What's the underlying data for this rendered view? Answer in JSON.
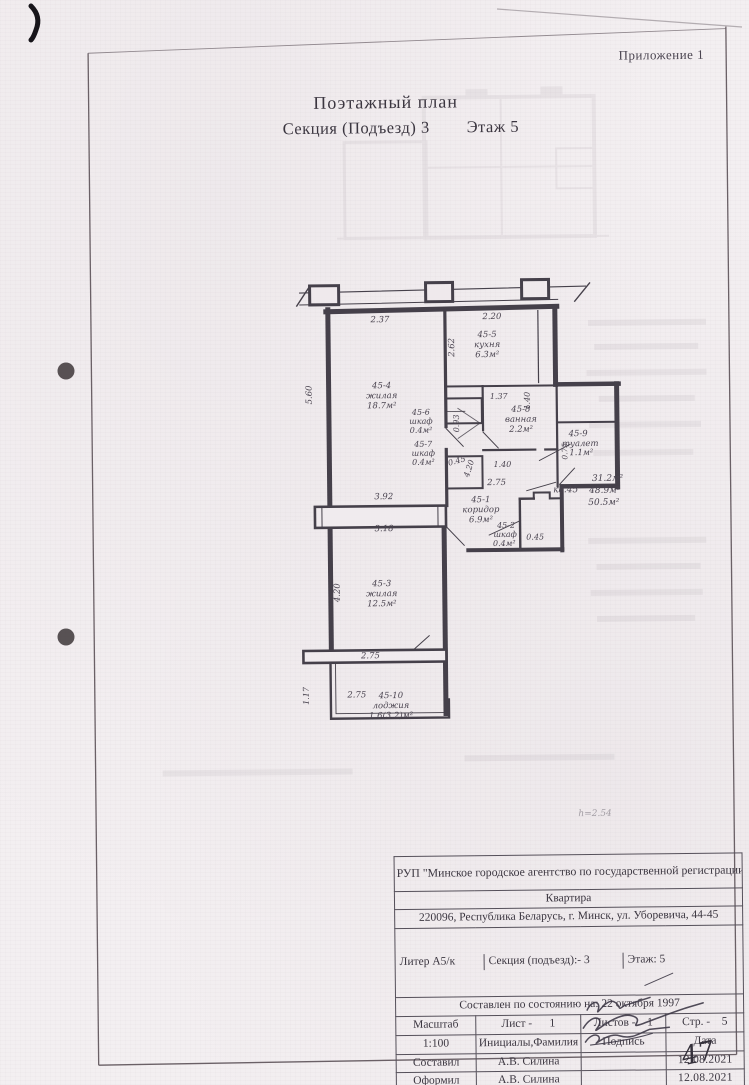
{
  "page": {
    "annex_label": "Приложение 1",
    "title_line1": "Поэтажный план",
    "title_line2": "Секция (Подъезд) 3        Этаж 5",
    "page_number_handwritten": "47"
  },
  "plan": {
    "apartment_ref": "кв.45",
    "areas_summary": [
      "31.2м²",
      "48.9м²",
      "50.5м²"
    ],
    "height_note": "h=2.54",
    "rooms": [
      {
        "number": "45-1",
        "name": "коридор",
        "area": "6.9м²"
      },
      {
        "number": "45-2",
        "name": "шкаф",
        "area": "0.4м²"
      },
      {
        "number": "45-3",
        "name": "жилая",
        "area": "12.5м²"
      },
      {
        "number": "45-4",
        "name": "жилая",
        "area": "18.7м²"
      },
      {
        "number": "45-5",
        "name": "кухня",
        "area": "6.3м²"
      },
      {
        "number": "45-6",
        "name": "шкаф",
        "area": "0.4м²"
      },
      {
        "number": "45-7",
        "name": "шкаф",
        "area": "0.4м²"
      },
      {
        "number": "45-8",
        "name": "ванная",
        "area": "2.2м²"
      },
      {
        "number": "45-9",
        "name": "туалет",
        "area": "1.1м²"
      },
      {
        "number": "45-10",
        "name": "лоджия",
        "area": "1.6(3.2)м²"
      }
    ],
    "dimensions": [
      "2.37",
      "2.20",
      "2.62",
      "5.60",
      "0.93",
      "1.37",
      "1.40",
      "0.75",
      "1.40",
      "0.45",
      "4.20",
      "2.75",
      "3.92",
      "3.18",
      "0.45",
      "4.20",
      "2.75",
      "2.75",
      "1.17"
    ],
    "labels": [
      {
        "t": "2.37",
        "x": 382,
        "y": 322,
        "r": 0,
        "s": 8.5
      },
      {
        "t": "2.20",
        "x": 494,
        "y": 320,
        "r": 0,
        "s": 8.5
      },
      {
        "t": "2.62",
        "x": 456,
        "y": 348,
        "r": -90,
        "s": 8.5
      },
      {
        "t": "5.60",
        "x": 313,
        "y": 394,
        "r": -90,
        "s": 8.5
      },
      {
        "t": "45-4",
        "x": 383,
        "y": 388,
        "r": 0,
        "s": 8.5
      },
      {
        "t": "жилая",
        "x": 383,
        "y": 398,
        "r": 0,
        "s": 8.5
      },
      {
        "t": "18.7м²",
        "x": 383,
        "y": 408,
        "r": 0,
        "s": 8.5
      },
      {
        "t": "45-5",
        "x": 489,
        "y": 338,
        "r": 0,
        "s": 8.5
      },
      {
        "t": "кухня",
        "x": 489,
        "y": 348,
        "r": 0,
        "s": 8.5
      },
      {
        "t": "6.3м²",
        "x": 489,
        "y": 358,
        "r": 0,
        "s": 8.5
      },
      {
        "t": "45-6",
        "x": 422,
        "y": 415,
        "r": 0,
        "s": 8
      },
      {
        "t": "шкаф",
        "x": 422,
        "y": 424,
        "r": 0,
        "s": 8
      },
      {
        "t": "0.4м²",
        "x": 422,
        "y": 433,
        "r": 0,
        "s": 8
      },
      {
        "t": "0.93",
        "x": 460,
        "y": 424,
        "r": -90,
        "s": 8
      },
      {
        "t": "1.37",
        "x": 500,
        "y": 400,
        "r": 0,
        "s": 8
      },
      {
        "t": "1.40",
        "x": 531,
        "y": 402,
        "r": -90,
        "s": 8
      },
      {
        "t": "45-8",
        "x": 522,
        "y": 413,
        "r": 0,
        "s": 8.5
      },
      {
        "t": "ванная",
        "x": 522,
        "y": 423,
        "r": 0,
        "s": 8.5
      },
      {
        "t": "2.2м²",
        "x": 522,
        "y": 433,
        "r": 0,
        "s": 8.5
      },
      {
        "t": "45-9",
        "x": 579,
        "y": 438,
        "r": 0,
        "s": 8.5
      },
      {
        "t": "туалет",
        "x": 581,
        "y": 448,
        "r": 0,
        "s": 8.5
      },
      {
        "t": "1.1м²",
        "x": 582,
        "y": 457,
        "r": 0,
        "s": 8.5
      },
      {
        "t": "0.75",
        "x": 568,
        "y": 453,
        "r": -90,
        "s": 7.5
      },
      {
        "t": "1.40",
        "x": 503,
        "y": 468,
        "r": 0,
        "s": 8
      },
      {
        "t": "45-7",
        "x": 424,
        "y": 447,
        "r": 0,
        "s": 8
      },
      {
        "t": "шкаф",
        "x": 424,
        "y": 456,
        "r": 0,
        "s": 8
      },
      {
        "t": "0.4м²",
        "x": 424,
        "y": 465,
        "r": 0,
        "s": 8
      },
      {
        "t": "0.45",
        "x": 458,
        "y": 464,
        "r": -15,
        "s": 8
      },
      {
        "t": "4.20",
        "x": 472,
        "y": 470,
        "r": -72,
        "s": 8
      },
      {
        "t": "2.75",
        "x": 497,
        "y": 486,
        "r": 0,
        "s": 8.5
      },
      {
        "t": "45-1",
        "x": 481,
        "y": 503,
        "r": 0,
        "s": 8.5
      },
      {
        "t": "коридор",
        "x": 481,
        "y": 513,
        "r": 0,
        "s": 8.5
      },
      {
        "t": "6.9м²",
        "x": 481,
        "y": 523,
        "r": 0,
        "s": 8.5
      },
      {
        "t": "кв.45",
        "x": 566,
        "y": 494,
        "r": 0,
        "s": 9
      },
      {
        "t": "31.2м²",
        "x": 608,
        "y": 483,
        "r": 0,
        "s": 9
      },
      {
        "t": "48.9м²",
        "x": 605,
        "y": 495,
        "r": 0,
        "s": 9
      },
      {
        "t": "50.5м²",
        "x": 604,
        "y": 507,
        "r": 0,
        "s": 9
      },
      {
        "t": "3.92",
        "x": 384,
        "y": 499,
        "r": 0,
        "s": 8.5
      },
      {
        "t": "3.18",
        "x": 384,
        "y": 531,
        "r": 0,
        "s": 8.5
      },
      {
        "t": "45-2",
        "x": 506,
        "y": 529,
        "r": 0,
        "s": 8
      },
      {
        "t": "шкаф",
        "x": 505,
        "y": 538,
        "r": 0,
        "s": 8
      },
      {
        "t": "0.4м²",
        "x": 504,
        "y": 547,
        "r": 0,
        "s": 8
      },
      {
        "t": "0.45",
        "x": 535,
        "y": 541,
        "r": 0,
        "s": 8
      },
      {
        "t": "4.20",
        "x": 339,
        "y": 592,
        "r": -90,
        "s": 8.5
      },
      {
        "t": "45-3",
        "x": 381,
        "y": 586,
        "r": 0,
        "s": 8.5
      },
      {
        "t": "жилая",
        "x": 381,
        "y": 596,
        "r": 0,
        "s": 8.5
      },
      {
        "t": "12.5м²",
        "x": 381,
        "y": 606,
        "r": 0,
        "s": 8.5
      },
      {
        "t": "2.75",
        "x": 369,
        "y": 658,
        "r": 0,
        "s": 8.5
      },
      {
        "t": "2.75",
        "x": 355,
        "y": 697,
        "r": 0,
        "s": 8.5
      },
      {
        "t": "45-10",
        "x": 389,
        "y": 698,
        "r": 0,
        "s": 8.5
      },
      {
        "t": "лоджия",
        "x": 389,
        "y": 708,
        "r": 0,
        "s": 8.5
      },
      {
        "t": "1.6(3.2)м²",
        "x": 389,
        "y": 718,
        "r": 0,
        "s": 8.5
      },
      {
        "t": "1.17",
        "x": 307,
        "y": 695,
        "r": -90,
        "s": 8
      },
      {
        "t": "h=2.54",
        "x": 592,
        "y": 818,
        "r": 0,
        "s": 9,
        "o": 0.45
      }
    ]
  },
  "titleblock": {
    "org_name": "РУП \"Минское городское агентство по государственной регистрации и земельному кадастру\"",
    "object_type": "Квартира",
    "address": "220096, Республика Беларусь, г. Минск, ул. Уборевича, 44-45",
    "liter_label": "Литер А5/к",
    "section_label": "Секция (подъезд):- 3",
    "floor_label": "Этаж: 5",
    "date_line": "Составлен по состоянию на: 22 октября 1997",
    "scale_header": "Масштаб",
    "sheet_header": "Лист -      1",
    "sheets_header": "Листов -    1",
    "page_header": "Стр. -    5",
    "scale_value": "1:100",
    "name_header": "Инициалы,Фамилия",
    "signature_header": "Подпись",
    "date_header": "Дата",
    "rows": [
      {
        "role": "Составил",
        "name": "А.В. Силина",
        "date": "12.08.2021"
      },
      {
        "role": "Оформил",
        "name": "А.В. Силина",
        "date": "12.08.2021"
      },
      {
        "role": "Проверил",
        "name": "Г.С. Харлап",
        "date": "12.08.2021"
      }
    ]
  }
}
